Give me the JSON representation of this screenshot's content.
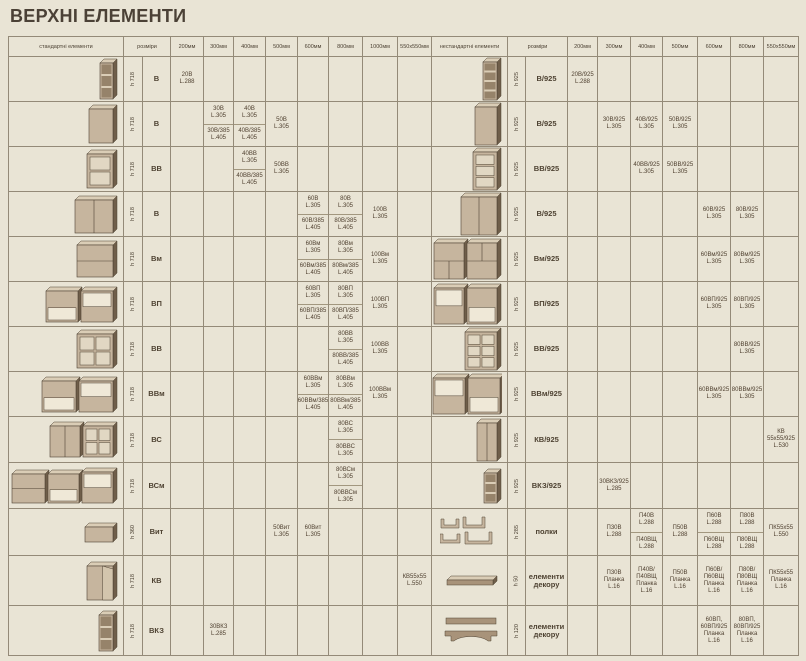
{
  "title": "ВЕРХНІ ЕЛЕМЕНТИ",
  "colors": {
    "background": "#e9e4d5",
    "grid_line": "#948a78",
    "text": "#4f4030",
    "title_text": "#4b4136",
    "cabinet_front": "#c6b59e",
    "cabinet_side": "#6f5e4a",
    "cabinet_top": "#dacdb6"
  },
  "left_table": {
    "element_header": "стандартні елементи",
    "size_header": "розміри",
    "columns": [
      "200мм",
      "300мм",
      "400мм",
      "500мм",
      "600мм",
      "800мм",
      "1000мм",
      "550х550мм"
    ],
    "rows": [
      {
        "height": "h 718",
        "code": "В",
        "illustration": "shelf-3",
        "cells": {
          "200мм": [
            [
              "20В",
              "L.288"
            ]
          ]
        }
      },
      {
        "height": "h 718",
        "code": "В",
        "illustration": "door-1",
        "cells": {
          "300мм": [
            [
              "30В",
              "L.305"
            ],
            [
              "30В/385",
              "L.405"
            ]
          ],
          "400мм": [
            [
              "40В",
              "L.305"
            ],
            [
              "40В/385",
              "L.405"
            ]
          ],
          "500мм": [
            [
              "50В",
              "L.305"
            ]
          ]
        }
      },
      {
        "height": "h 718",
        "code": "ВВ",
        "illustration": "glass-2",
        "cells": {
          "400мм": [
            [
              "40ВВ",
              "L.305"
            ],
            [
              "40ВВ/385",
              "L.405"
            ]
          ],
          "500мм": [
            [
              "50ВВ",
              "L.305"
            ]
          ]
        }
      },
      {
        "height": "h 718",
        "code": "В",
        "illustration": "door-2",
        "cells": {
          "600мм": [
            [
              "60В",
              "L.305"
            ],
            [
              "60В/385",
              "L.405"
            ]
          ],
          "800мм": [
            [
              "80В",
              "L.305"
            ],
            [
              "80В/385",
              "L.405"
            ]
          ],
          "1000мм": [
            [
              "100В",
              "L.305"
            ]
          ]
        }
      },
      {
        "height": "h 718",
        "code": "Вм",
        "illustration": "flap",
        "cells": {
          "600мм": [
            [
              "60Вм",
              "L.305"
            ],
            [
              "60Вм/385",
              "L.405"
            ]
          ],
          "800мм": [
            [
              "80Вм",
              "L.305"
            ],
            [
              "80Вм/385",
              "L.405"
            ]
          ],
          "1000мм": [
            [
              "100Вм",
              "L.305"
            ]
          ]
        }
      },
      {
        "height": "h 718",
        "code": "ВП",
        "illustration": "niche-pair",
        "cells": {
          "600мм": [
            [
              "60ВП",
              "L.305"
            ],
            [
              "60ВП/385",
              "L.405"
            ]
          ],
          "800мм": [
            [
              "80ВП",
              "L.305"
            ],
            [
              "80ВП/385",
              "L.405"
            ]
          ],
          "1000мм": [
            [
              "100ВП",
              "L.305"
            ]
          ]
        }
      },
      {
        "height": "h 718",
        "code": "ВВ",
        "illustration": "glass-4",
        "cells": {
          "800мм": [
            [
              "80ВВ",
              "L.305"
            ],
            [
              "80ВВ/385",
              "L.405"
            ]
          ],
          "1000мм": [
            [
              "100ВВ",
              "L.305"
            ]
          ]
        }
      },
      {
        "height": "h 718",
        "code": "ВВм",
        "illustration": "niche-flap-pair",
        "cells": {
          "600мм": [
            [
              "60ВВм",
              "L.305"
            ],
            [
              "60ВВм/385",
              "L.405"
            ]
          ],
          "800мм": [
            [
              "80ВВм",
              "L.305"
            ],
            [
              "80ВВм/385",
              "L.405"
            ]
          ],
          "1000мм": [
            [
              "100ВВм",
              "L.305"
            ]
          ]
        }
      },
      {
        "height": "h 718",
        "code": "ВС",
        "illustration": "door-glass-pair",
        "cells": {
          "800мм": [
            [
              "80ВС",
              "L.305"
            ],
            [
              "80ВВС",
              "L.305"
            ]
          ]
        }
      },
      {
        "height": "h 718",
        "code": "ВСм",
        "illustration": "triple-combo",
        "cells": {
          "800мм": [
            [
              "80ВСм",
              "L.305"
            ],
            [
              "80ВВСм",
              "L.305"
            ]
          ]
        }
      },
      {
        "height": "h 360",
        "code": "Вит",
        "illustration": "low-box",
        "cells": {
          "500мм": [
            [
              "50Вит",
              "L.305"
            ]
          ],
          "600мм": [
            [
              "60Вит",
              "L.305"
            ]
          ]
        }
      },
      {
        "height": "h 718",
        "code": "КВ",
        "illustration": "corner",
        "cells": {
          "550х550мм": [
            [
              "КВ55х55",
              "L.550"
            ]
          ]
        }
      },
      {
        "height": "h 718",
        "code": "ВКЗ",
        "illustration": "shelf-3-open",
        "cells": {
          "300мм": [
            [
              "30ВКЗ",
              "L.285"
            ]
          ]
        }
      }
    ]
  },
  "right_table": {
    "element_header": "нестандартні елементи",
    "size_header": "розміри",
    "columns": [
      "200мм",
      "300мм",
      "400мм",
      "500мм",
      "600мм",
      "800мм",
      "550х550мм"
    ],
    "rows": [
      {
        "height": "h 925",
        "code": "В/925",
        "illustration": "shelf-4-tall",
        "cells": {
          "200мм": [
            [
              "20В/925",
              "L.288"
            ]
          ]
        }
      },
      {
        "height": "h 925",
        "code": "В/925",
        "illustration": "door-1-tall",
        "cells": {
          "300мм": [
            [
              "30В/925",
              "L.305"
            ]
          ],
          "400мм": [
            [
              "40В/925",
              "L.305"
            ]
          ],
          "500мм": [
            [
              "50В/925",
              "L.305"
            ]
          ]
        }
      },
      {
        "height": "h 925",
        "code": "ВВ/925",
        "illustration": "glass-3-tall",
        "cells": {
          "400мм": [
            [
              "40ВВ/925",
              "L.305"
            ]
          ],
          "500мм": [
            [
              "50ВВ/925",
              "L.305"
            ]
          ]
        }
      },
      {
        "height": "h 925",
        "code": "В/925",
        "illustration": "door-2-tall",
        "cells": {
          "600мм": [
            [
              "60В/925",
              "L.305"
            ]
          ],
          "800мм": [
            [
              "80В/925",
              "L.305"
            ]
          ]
        }
      },
      {
        "height": "h 925",
        "code": "Вм/925",
        "illustration": "flap-pair-tall",
        "cells": {
          "600мм": [
            [
              "60Вм/925",
              "L.305"
            ]
          ],
          "800мм": [
            [
              "80Вм/925",
              "L.305"
            ]
          ]
        }
      },
      {
        "height": "h 925",
        "code": "ВП/925",
        "illustration": "niche-pair-tall",
        "cells": {
          "600мм": [
            [
              "60ВП/925",
              "L.305"
            ]
          ],
          "800мм": [
            [
              "80ВП/925",
              "L.305"
            ]
          ]
        }
      },
      {
        "height": "h 925",
        "code": "ВВ/925",
        "illustration": "glass-6-tall",
        "cells": {
          "800мм": [
            [
              "80ВВ/925",
              "L.305"
            ]
          ]
        }
      },
      {
        "height": "h 925",
        "code": "ВВм/925",
        "illustration": "niche-flap-pair-tall",
        "cells": {
          "600мм": [
            [
              "60ВВм/925",
              "L.305"
            ]
          ],
          "800мм": [
            [
              "80ВВм/925",
              "L.305"
            ]
          ]
        }
      },
      {
        "height": "h 925",
        "code": "КВ/925",
        "illustration": "corner-tall",
        "cells": {
          "550х550мм": [
            [
              "КВ",
              "55х55/925",
              "L.530"
            ]
          ]
        }
      },
      {
        "height": "h 925",
        "code": "ВКЗ/925",
        "illustration": "shelf-3-small",
        "cells": {
          "300мм": [
            [
              "30ВКЗ/925",
              "L.285"
            ]
          ]
        }
      },
      {
        "height": "h 285",
        "code": "полки",
        "illustration": "shelf-set",
        "cells": {
          "300мм": [
            [
              "П30В",
              "L.288"
            ]
          ],
          "400мм": [
            [
              "П40В",
              "L.288"
            ],
            [
              "П40ВЩ",
              "L.288"
            ]
          ],
          "500мм": [
            [
              "П50В",
              "L.288"
            ]
          ],
          "600мм": [
            [
              "П60В",
              "L.288"
            ],
            [
              "П60ВЩ",
              "L.288"
            ]
          ],
          "800мм": [
            [
              "П80В",
              "L.288"
            ],
            [
              "П80ВЩ",
              "L.288"
            ]
          ],
          "550х550мм": [
            [
              "ПК55х55",
              "L.550"
            ]
          ]
        }
      },
      {
        "height": "h 50",
        "code": "елементи декору",
        "illustration": "plank",
        "cells": {
          "300мм": [
            [
              "П30В",
              "Планка",
              "L.16"
            ]
          ],
          "400мм": [
            [
              "П40В/П40ВЩ",
              "Планка",
              "L.16"
            ]
          ],
          "500мм": [
            [
              "П50В",
              "Планка",
              "L.16"
            ]
          ],
          "600мм": [
            [
              "П60В/П60ВЩ",
              "Планка",
              "L.16"
            ]
          ],
          "800мм": [
            [
              "П80В/П80ВЩ",
              "Планка",
              "L.16"
            ]
          ],
          "550х550мм": [
            [
              "ПК55х55",
              "Планка",
              "L.16"
            ]
          ]
        }
      },
      {
        "height": "h 120",
        "code": "елементи декору",
        "illustration": "cornice-pair",
        "cells": {
          "600мм": [
            [
              "60ВП,",
              "60ВП/925",
              "Планка",
              "L.16"
            ]
          ],
          "800мм": [
            [
              "80ВП,",
              "80ВП/925",
              "Планка",
              "L.16"
            ]
          ]
        }
      }
    ]
  }
}
